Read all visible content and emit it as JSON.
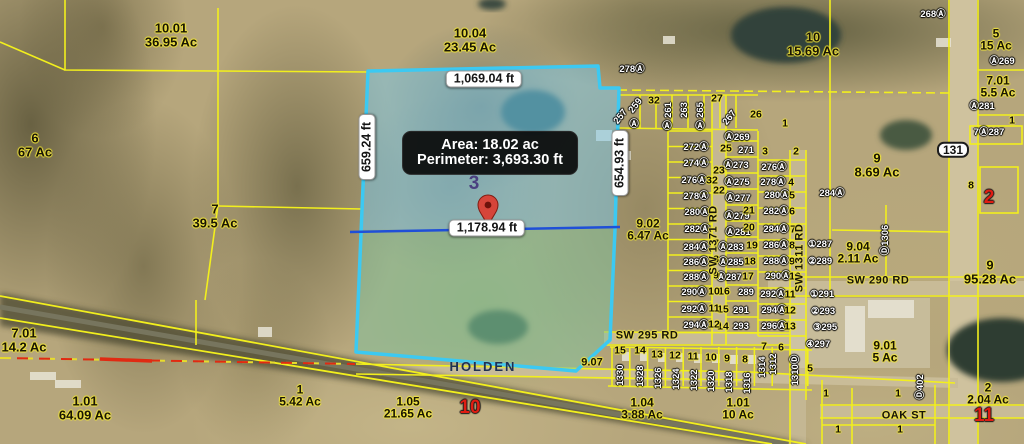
{
  "selection": {
    "parcel_number": "3",
    "tooltip": {
      "area": "Area: 18.02 ac",
      "perimeter": "Perimeter: 3,693.30 ft"
    },
    "measurements": {
      "top": "1,069.04 ft",
      "left": "659.24 ft",
      "right": "654.93 ft",
      "bottom": "1,178.94 ft"
    },
    "colors": {
      "boundary": "#3cc9f2",
      "fill_north": "rgba(120,200,235,0.5)",
      "fill_south": "rgba(125,195,160,0.5)",
      "measure_line": "#1f4fd8",
      "pin": "#d6453a"
    }
  },
  "route_shield": {
    "text": "131"
  },
  "city_label": {
    "text": "HOLDEN"
  },
  "parcel_labels": [
    {
      "id": "10.01",
      "ac": "36.95 Ac",
      "x": 171,
      "y": 35,
      "s": 13
    },
    {
      "id": "10.04",
      "ac": "23.45 Ac",
      "x": 470,
      "y": 40,
      "s": 13
    },
    {
      "id": "6",
      "ac": "67 Ac",
      "x": 35,
      "y": 145,
      "s": 13
    },
    {
      "id": "7",
      "ac": "39.5 Ac",
      "x": 215,
      "y": 216,
      "s": 13
    },
    {
      "id": "10",
      "ac": "15.69 Ac",
      "x": 813,
      "y": 44,
      "s": 13
    },
    {
      "id": "5",
      "ac": "15 Ac",
      "x": 996,
      "y": 40,
      "s": 12
    },
    {
      "id": "7.01",
      "ac": "5.5 Ac",
      "x": 998,
      "y": 87,
      "s": 12
    },
    {
      "id": "9",
      "ac": "8.69 Ac",
      "x": 877,
      "y": 165,
      "s": 13
    },
    {
      "id": "9.02",
      "ac": "6.47 Ac",
      "x": 648,
      "y": 230,
      "s": 12
    },
    {
      "id": "9",
      "ac": "95.28 Ac",
      "x": 990,
      "y": 272,
      "s": 13
    },
    {
      "id": "9.04",
      "ac": "2.11 Ac",
      "x": 858,
      "y": 253,
      "s": 12
    },
    {
      "id": "9.01",
      "ac": "5 Ac",
      "x": 885,
      "y": 352,
      "s": 12
    },
    {
      "id": "2",
      "ac": "2.04 Ac",
      "x": 988,
      "y": 394,
      "s": 12
    },
    {
      "id": "7.01",
      "ac": "14.2 Ac",
      "x": 24,
      "y": 340,
      "s": 13
    },
    {
      "id": "1.01",
      "ac": "64.09 Ac",
      "x": 85,
      "y": 408,
      "s": 13
    },
    {
      "id": "1",
      "ac": "5.42 Ac",
      "x": 300,
      "y": 396,
      "s": 12
    },
    {
      "id": "1.05",
      "ac": "21.65 Ac",
      "x": 408,
      "y": 408,
      "s": 12
    },
    {
      "id": "1.04",
      "ac": "3.88 Ac",
      "x": 642,
      "y": 409,
      "s": 12
    },
    {
      "id": "1.01",
      "ac": "10 Ac",
      "x": 738,
      "y": 409,
      "s": 12
    },
    {
      "id": "9.07",
      "ac": "",
      "x": 592,
      "y": 363,
      "s": 11
    }
  ],
  "address_labels": [
    [
      "272Ⓐ",
      696,
      148
    ],
    [
      "274Ⓐ",
      696,
      164
    ],
    [
      "276Ⓐ",
      694,
      181
    ],
    [
      "278Ⓐ",
      696,
      197
    ],
    [
      "280Ⓐ",
      697,
      213
    ],
    [
      "282Ⓐ",
      697,
      230
    ],
    [
      "284Ⓐ",
      696,
      248
    ],
    [
      "286Ⓐ",
      696,
      263
    ],
    [
      "288Ⓐ",
      696,
      278
    ],
    [
      "290Ⓐ",
      694,
      293
    ],
    [
      "292Ⓐ",
      694,
      310
    ],
    [
      "294Ⓐ",
      696,
      326
    ],
    [
      "271",
      746,
      151
    ],
    [
      "Ⓐ273",
      736,
      166
    ],
    [
      "Ⓐ275",
      737,
      183
    ],
    [
      "Ⓐ277",
      738,
      199
    ],
    [
      "Ⓐ279",
      737,
      217
    ],
    [
      "Ⓐ281",
      738,
      233
    ],
    [
      "Ⓐ283",
      731,
      248
    ],
    [
      "Ⓐ285",
      731,
      263
    ],
    [
      "Ⓐ287",
      729,
      278
    ],
    [
      "289",
      746,
      293
    ],
    [
      "291",
      741,
      311
    ],
    [
      "293",
      741,
      327
    ],
    [
      "276Ⓐ",
      774,
      168
    ],
    [
      "278Ⓐ",
      773,
      183
    ],
    [
      "280Ⓐ",
      777,
      196
    ],
    [
      "282Ⓐ",
      776,
      212
    ],
    [
      "284Ⓐ",
      776,
      230
    ],
    [
      "286Ⓐ",
      776,
      246
    ],
    [
      "288Ⓐ",
      776,
      262
    ],
    [
      "290Ⓐ",
      778,
      277
    ],
    [
      "292Ⓐ",
      773,
      295
    ],
    [
      "294Ⓐ",
      774,
      311
    ],
    [
      "296Ⓐ",
      774,
      327
    ],
    [
      "Ⓐ269",
      737,
      138
    ],
    [
      "Ⓐ269",
      1002,
      62
    ],
    [
      "Ⓐ281",
      982,
      107
    ],
    [
      "268Ⓐ",
      933,
      15
    ],
    [
      "278Ⓐ",
      632,
      70
    ],
    [
      "284Ⓐ",
      832,
      194
    ],
    [
      "7Ⓐ287",
      989,
      133
    ],
    [
      "①287",
      820,
      245
    ],
    [
      "②289",
      820,
      262
    ],
    [
      "①291",
      822,
      295
    ],
    [
      "②293",
      823,
      312
    ],
    [
      "③295",
      825,
      328
    ],
    [
      "④297",
      818,
      345
    ],
    [
      "Ⓓ1306",
      886,
      240,
      -90
    ],
    [
      "Ⓓ402",
      921,
      387,
      -90
    ],
    [
      "259",
      636,
      106,
      -52
    ],
    [
      "257",
      621,
      117,
      -52
    ],
    [
      "261",
      669,
      110,
      -90
    ],
    [
      "263",
      685,
      110,
      -90
    ],
    [
      "265",
      701,
      110,
      -90
    ],
    [
      "267",
      730,
      118,
      -52
    ],
    [
      "1330",
      621,
      375,
      -90
    ],
    [
      "1328",
      641,
      376,
      -90
    ],
    [
      "1326",
      659,
      378,
      -90
    ],
    [
      "1324",
      677,
      379,
      -90
    ],
    [
      "1322",
      695,
      380,
      -90
    ],
    [
      "1320",
      712,
      381,
      -90
    ],
    [
      "1318",
      730,
      382,
      -90
    ],
    [
      "1316",
      748,
      383,
      -90
    ],
    [
      "1314",
      763,
      367,
      -90
    ],
    [
      "1312",
      774,
      364,
      -90
    ],
    [
      "1310Ⓓ",
      796,
      370,
      -90
    ],
    [
      "Ⓐ",
      634,
      125
    ],
    [
      "Ⓐ",
      667,
      127
    ],
    [
      "Ⓐ",
      700,
      127
    ]
  ],
  "lot_labels": [
    [
      "32",
      654,
      101
    ],
    [
      "27",
      717,
      99
    ],
    [
      "26",
      756,
      115
    ],
    [
      "25",
      726,
      149
    ],
    [
      "23",
      719,
      171
    ],
    [
      "22",
      719,
      191
    ],
    [
      "21",
      749,
      211
    ],
    [
      "20",
      749,
      228
    ],
    [
      "19",
      752,
      246
    ],
    [
      "18",
      750,
      262
    ],
    [
      "17",
      748,
      277
    ],
    [
      "16",
      724,
      292
    ],
    [
      "15",
      723,
      310
    ],
    [
      "14",
      723,
      327
    ],
    [
      "7",
      716,
      244
    ],
    [
      "8",
      716,
      260
    ],
    [
      "9",
      716,
      276
    ],
    [
      "10",
      714,
      292
    ],
    [
      "11",
      714,
      309
    ],
    [
      "12",
      714,
      325
    ],
    [
      "4",
      791,
      183
    ],
    [
      "5",
      792,
      196
    ],
    [
      "6",
      792,
      212
    ],
    [
      "7",
      793,
      230
    ],
    [
      "8",
      792,
      246
    ],
    [
      "9",
      792,
      262
    ],
    [
      "10",
      795,
      277
    ],
    [
      "11",
      790,
      295
    ],
    [
      "12",
      790,
      311
    ],
    [
      "13",
      790,
      327
    ],
    [
      "15",
      620,
      351
    ],
    [
      "14",
      640,
      351
    ],
    [
      "13",
      657,
      355
    ],
    [
      "12",
      675,
      356
    ],
    [
      "11",
      693,
      357
    ],
    [
      "10",
      711,
      358
    ],
    [
      "9",
      727,
      359
    ],
    [
      "8",
      745,
      360
    ],
    [
      "7",
      764,
      347
    ],
    [
      "6",
      781,
      348
    ],
    [
      "5",
      810,
      369
    ],
    [
      "1",
      785,
      124
    ],
    [
      "2",
      796,
      152
    ],
    [
      "3",
      765,
      152
    ],
    [
      "32",
      712,
      181
    ],
    [
      "1",
      1012,
      121
    ],
    [
      "8",
      971,
      186
    ],
    [
      "1",
      826,
      394
    ],
    [
      "1",
      898,
      394
    ],
    [
      "1",
      838,
      430
    ],
    [
      "1",
      900,
      430
    ]
  ],
  "road_labels": [
    [
      "SW 290 RD",
      878,
      281,
      0
    ],
    [
      "SW 295 RD",
      647,
      336,
      0
    ],
    [
      "OAK ST",
      904,
      416,
      0
    ],
    [
      "SW 1371 RD",
      714,
      240,
      -90
    ],
    [
      "SW 1311 RD",
      800,
      258,
      -90
    ]
  ],
  "red_labels": [
    [
      "10",
      470,
      408
    ],
    [
      "11",
      984,
      416
    ],
    [
      "2",
      989,
      198
    ]
  ]
}
